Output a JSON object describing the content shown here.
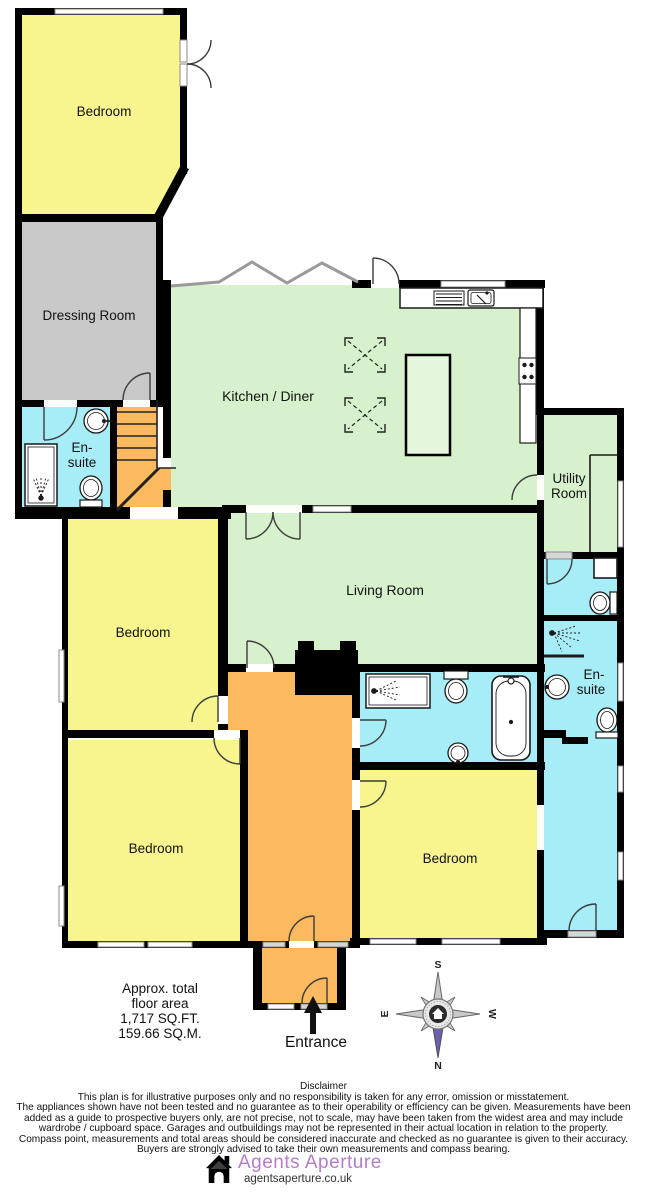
{
  "rooms": {
    "bedroom_top_left": "Bedroom",
    "dressing_room": "Dressing Room",
    "ensuite_top_line1": "En-",
    "ensuite_top_line2": "suite",
    "kitchen_diner": "Kitchen / Diner",
    "utility_line1": "Utility",
    "utility_line2": "Room",
    "living_room": "Living Room",
    "bedroom_mid_left": "Bedroom",
    "bedroom_bottom_left": "Bedroom",
    "bedroom_bottom_right": "Bedroom",
    "ensuite_right_line1": "En-",
    "ensuite_right_line2": "suite"
  },
  "area_summary": {
    "line1": "Approx. total",
    "line2": "floor area",
    "line3": "1,717 SQ.FT.",
    "line4": "159.66 SQ.M."
  },
  "entrance_label": "Entrance",
  "compass": {
    "north": "N",
    "south": "S",
    "east": "E",
    "west": "W"
  },
  "disclaimer": {
    "title": "Disclaimer",
    "lines": [
      "This plan is for illustrative purposes only and no responsibility is taken for any error, omission or misstatement.",
      "The appliances shown have not been tested and no guarantee as to their operability or efficiency can be given. Measurements have been",
      "added as a guide to prospective buyers only, are not precise, not to scale, may have been taken from the widest area and may include",
      "wardrobe / cupboard space. Garages and outbuildings may not be represented in their actual location in relation to  the property.",
      "Compass point, measurements and total areas should be considered inaccurate and checked as no guarantee is given to their accuracy.",
      "Buyers are strongly advised to take their own measurements and compass bearing."
    ]
  },
  "branding": {
    "name": "Agents Aperture",
    "website": "agentsaperture.co.uk"
  },
  "colors": {
    "bedroom": "#F8F58E",
    "reception": "#D6F1CC",
    "bathroom": "#A7EDF8",
    "hallway": "#FBBA5F",
    "dressing": "#C9C9C9",
    "wall": "#000000",
    "brand": "#B57EC8",
    "compass_needle": "#6A61AC"
  }
}
